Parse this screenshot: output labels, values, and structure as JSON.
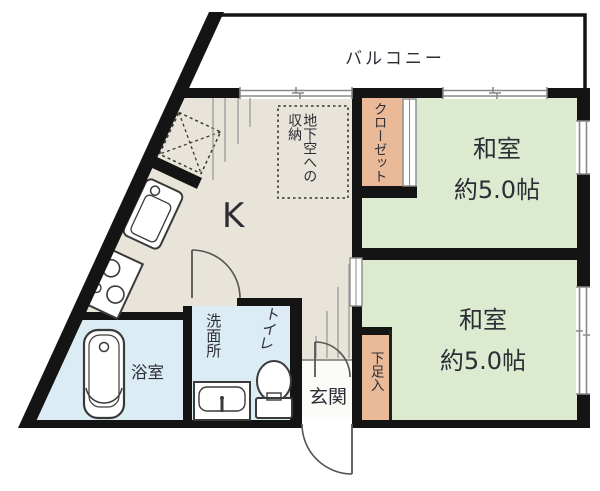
{
  "colors": {
    "wall": "#141414",
    "kitchen": "#e9e4da",
    "room": "#dcead0",
    "closet": "#eaba98",
    "bath": "#dcecf4",
    "entrance": "#fbfbf8",
    "text": "#2d2d35",
    "line": "#8a8a8a"
  },
  "rooms": {
    "balcony": {
      "label": "バルコニー"
    },
    "kitchen": {
      "label": "K"
    },
    "underfloor_storage": {
      "line1": "地下空への",
      "line2": "収納"
    },
    "closet": {
      "label": "クローゼット"
    },
    "japanese_room_upper": {
      "name": "和室",
      "size": "約5.0帖"
    },
    "japanese_room_lower": {
      "name": "和室",
      "size": "約5.0帖"
    },
    "bathroom": {
      "label": "浴室"
    },
    "washroom": {
      "label": "洗面所"
    },
    "toilet": {
      "label": "トイレ"
    },
    "entrance": {
      "label": "玄関"
    },
    "shoe_cabinet": {
      "label": "下足入"
    }
  }
}
